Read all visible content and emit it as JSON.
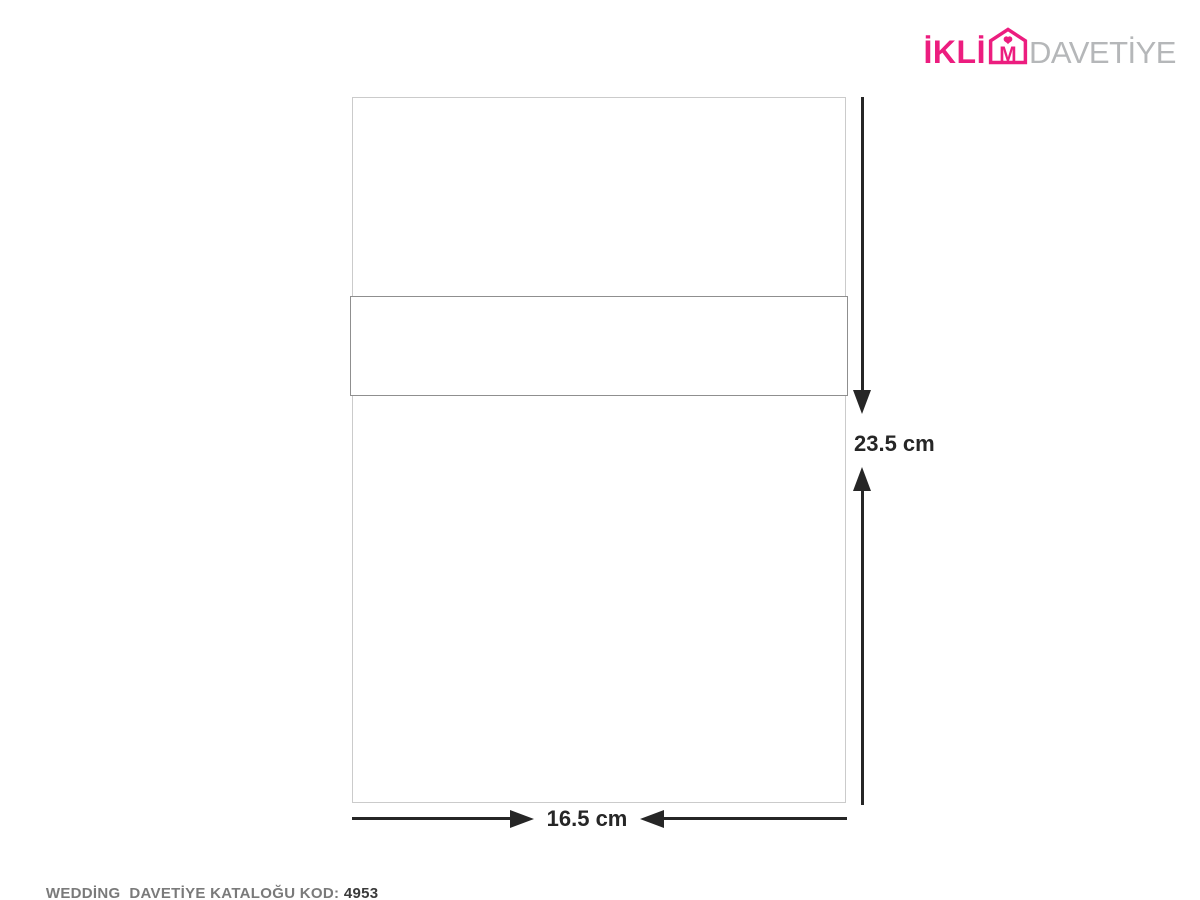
{
  "brand": {
    "name_pre": "İKLİ",
    "envelope_letter": "M",
    "name_secondary": "DAVETİYE"
  },
  "diagram": {
    "height_label": "23.5 cm",
    "width_label": "16.5 cm"
  },
  "footer": {
    "label": "WEDDİNG  DAVETİYE KATALOĞU KOD: ",
    "code": "4953"
  },
  "colors": {
    "brand_pink": "#EC1D7F",
    "brand_gray": "#B5B7B9",
    "line": "#262626",
    "outer_border": "#CBCBCB",
    "band_border": "#8F8F8F",
    "caption_gray": "#7A7A7A",
    "caption_dark": "#3A3A3A"
  }
}
